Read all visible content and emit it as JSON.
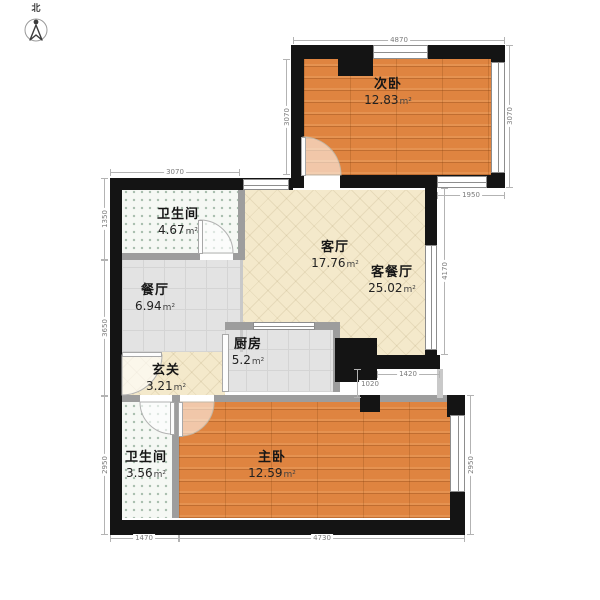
{
  "compass": {
    "north_label": "北"
  },
  "area_unit": "m²",
  "rooms": {
    "bedroom2": {
      "name": "次卧",
      "area": "12.83"
    },
    "bath1": {
      "name": "卫生间",
      "area": "4.67"
    },
    "living": {
      "name": "客厅",
      "area": "17.76"
    },
    "living_dining": {
      "name": "客餐厅",
      "area": "25.02"
    },
    "dining": {
      "name": "餐厅",
      "area": "6.94"
    },
    "kitchen": {
      "name": "厨房",
      "area": "5.2"
    },
    "foyer": {
      "name": "玄关",
      "area": "3.21"
    },
    "bath2": {
      "name": "卫生间",
      "area": "3.56"
    },
    "bedroom1": {
      "name": "主卧",
      "area": "12.59"
    }
  },
  "dimensions": {
    "top": "4870",
    "bedroom2_left": "3070",
    "bedroom2_right": "3070",
    "bedroom2_bottom": "1950",
    "bath1_top": "3070",
    "left_upper": "1350",
    "left_middle": "3650",
    "left_lower": "2950",
    "living_right": "4170",
    "step_width": "1420",
    "step_height": "1020",
    "master_right": "2950",
    "bottom_left": "1470",
    "bottom_right": "4730"
  },
  "colors": {
    "wall": "#141414",
    "partition": "#9d9d9d",
    "wood_floor": "#df8440",
    "tile_beige": "#f4e9cb",
    "tile_gray": "#e3e3e3",
    "bath_tile": "#f5f8f4"
  }
}
